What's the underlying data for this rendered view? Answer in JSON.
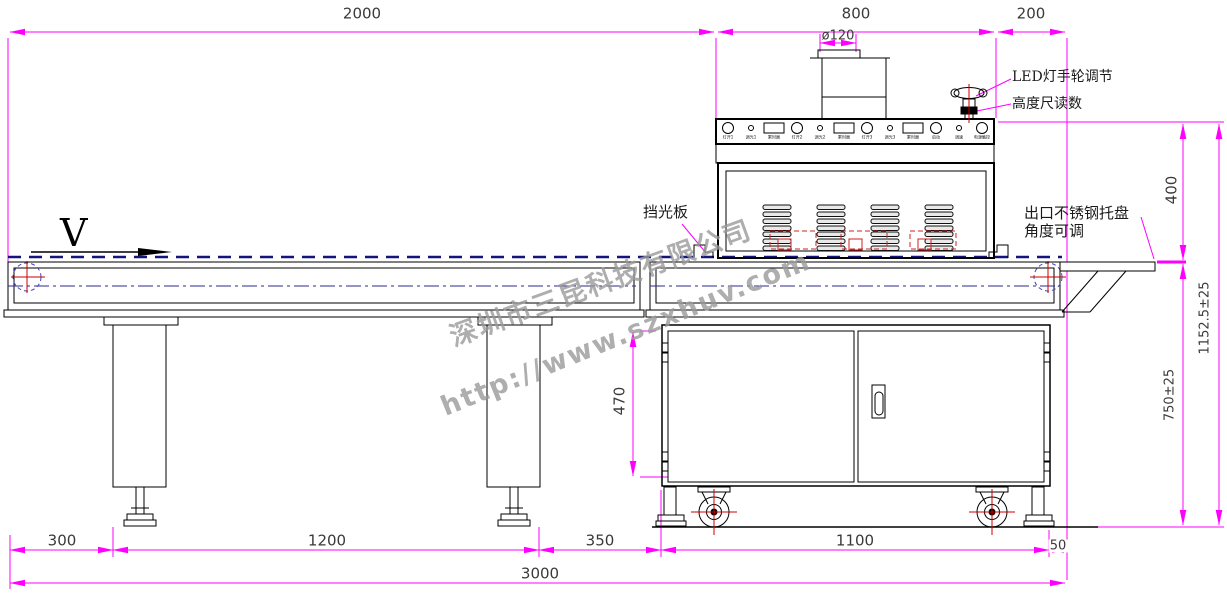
{
  "dims": {
    "infeed_length": "2000",
    "machine_length": "800",
    "outfeed_length": "200",
    "duct_diameter": "ø120",
    "machine_height_above_belt": "400",
    "overall_height": "1152.5±25",
    "belt_height": "750±25",
    "cabinet_clearance": "470",
    "leg_offset": "300",
    "leg_spacing": "1200",
    "leg_to_cabinet": "350",
    "cabinet_width": "1100",
    "cabinet_to_end": "50",
    "total_length": "3000"
  },
  "annotations": {
    "led_adjust": "LED灯手轮调节",
    "height_gauge": "高度尺读数",
    "light_shield": "挡光板",
    "outlet_tray_line1": "出口不锈钢托盘",
    "outlet_tray_line2": "角度可调",
    "belt_direction": "V"
  },
  "panel": {
    "controls": [
      {
        "type": "big-circle",
        "label": "灯开1"
      },
      {
        "type": "small-dot",
        "label": "调光1"
      },
      {
        "type": "rect",
        "label": "累时器"
      },
      {
        "type": "big-circle",
        "label": "灯开2"
      },
      {
        "type": "small-dot",
        "label": "调光2"
      },
      {
        "type": "rect",
        "label": "累时器"
      },
      {
        "type": "big-circle",
        "label": "灯开3"
      },
      {
        "type": "small-dot",
        "label": "调光3"
      },
      {
        "type": "rect",
        "label": "累时器"
      },
      {
        "type": "big-circle",
        "label": "启动"
      },
      {
        "type": "small-dot",
        "label": "调速"
      },
      {
        "type": "big-circle",
        "label": "电源触控"
      }
    ]
  },
  "watermarks": {
    "company": "深圳市三昆科技有限公司",
    "url": "http://www.szxhuv.com"
  },
  "colors": {
    "dimension": "#FF00FF",
    "outline": "#000000",
    "centerline": "#1a1a8c",
    "highlight": "#CC0000",
    "watermark": "#9A9A9A"
  }
}
